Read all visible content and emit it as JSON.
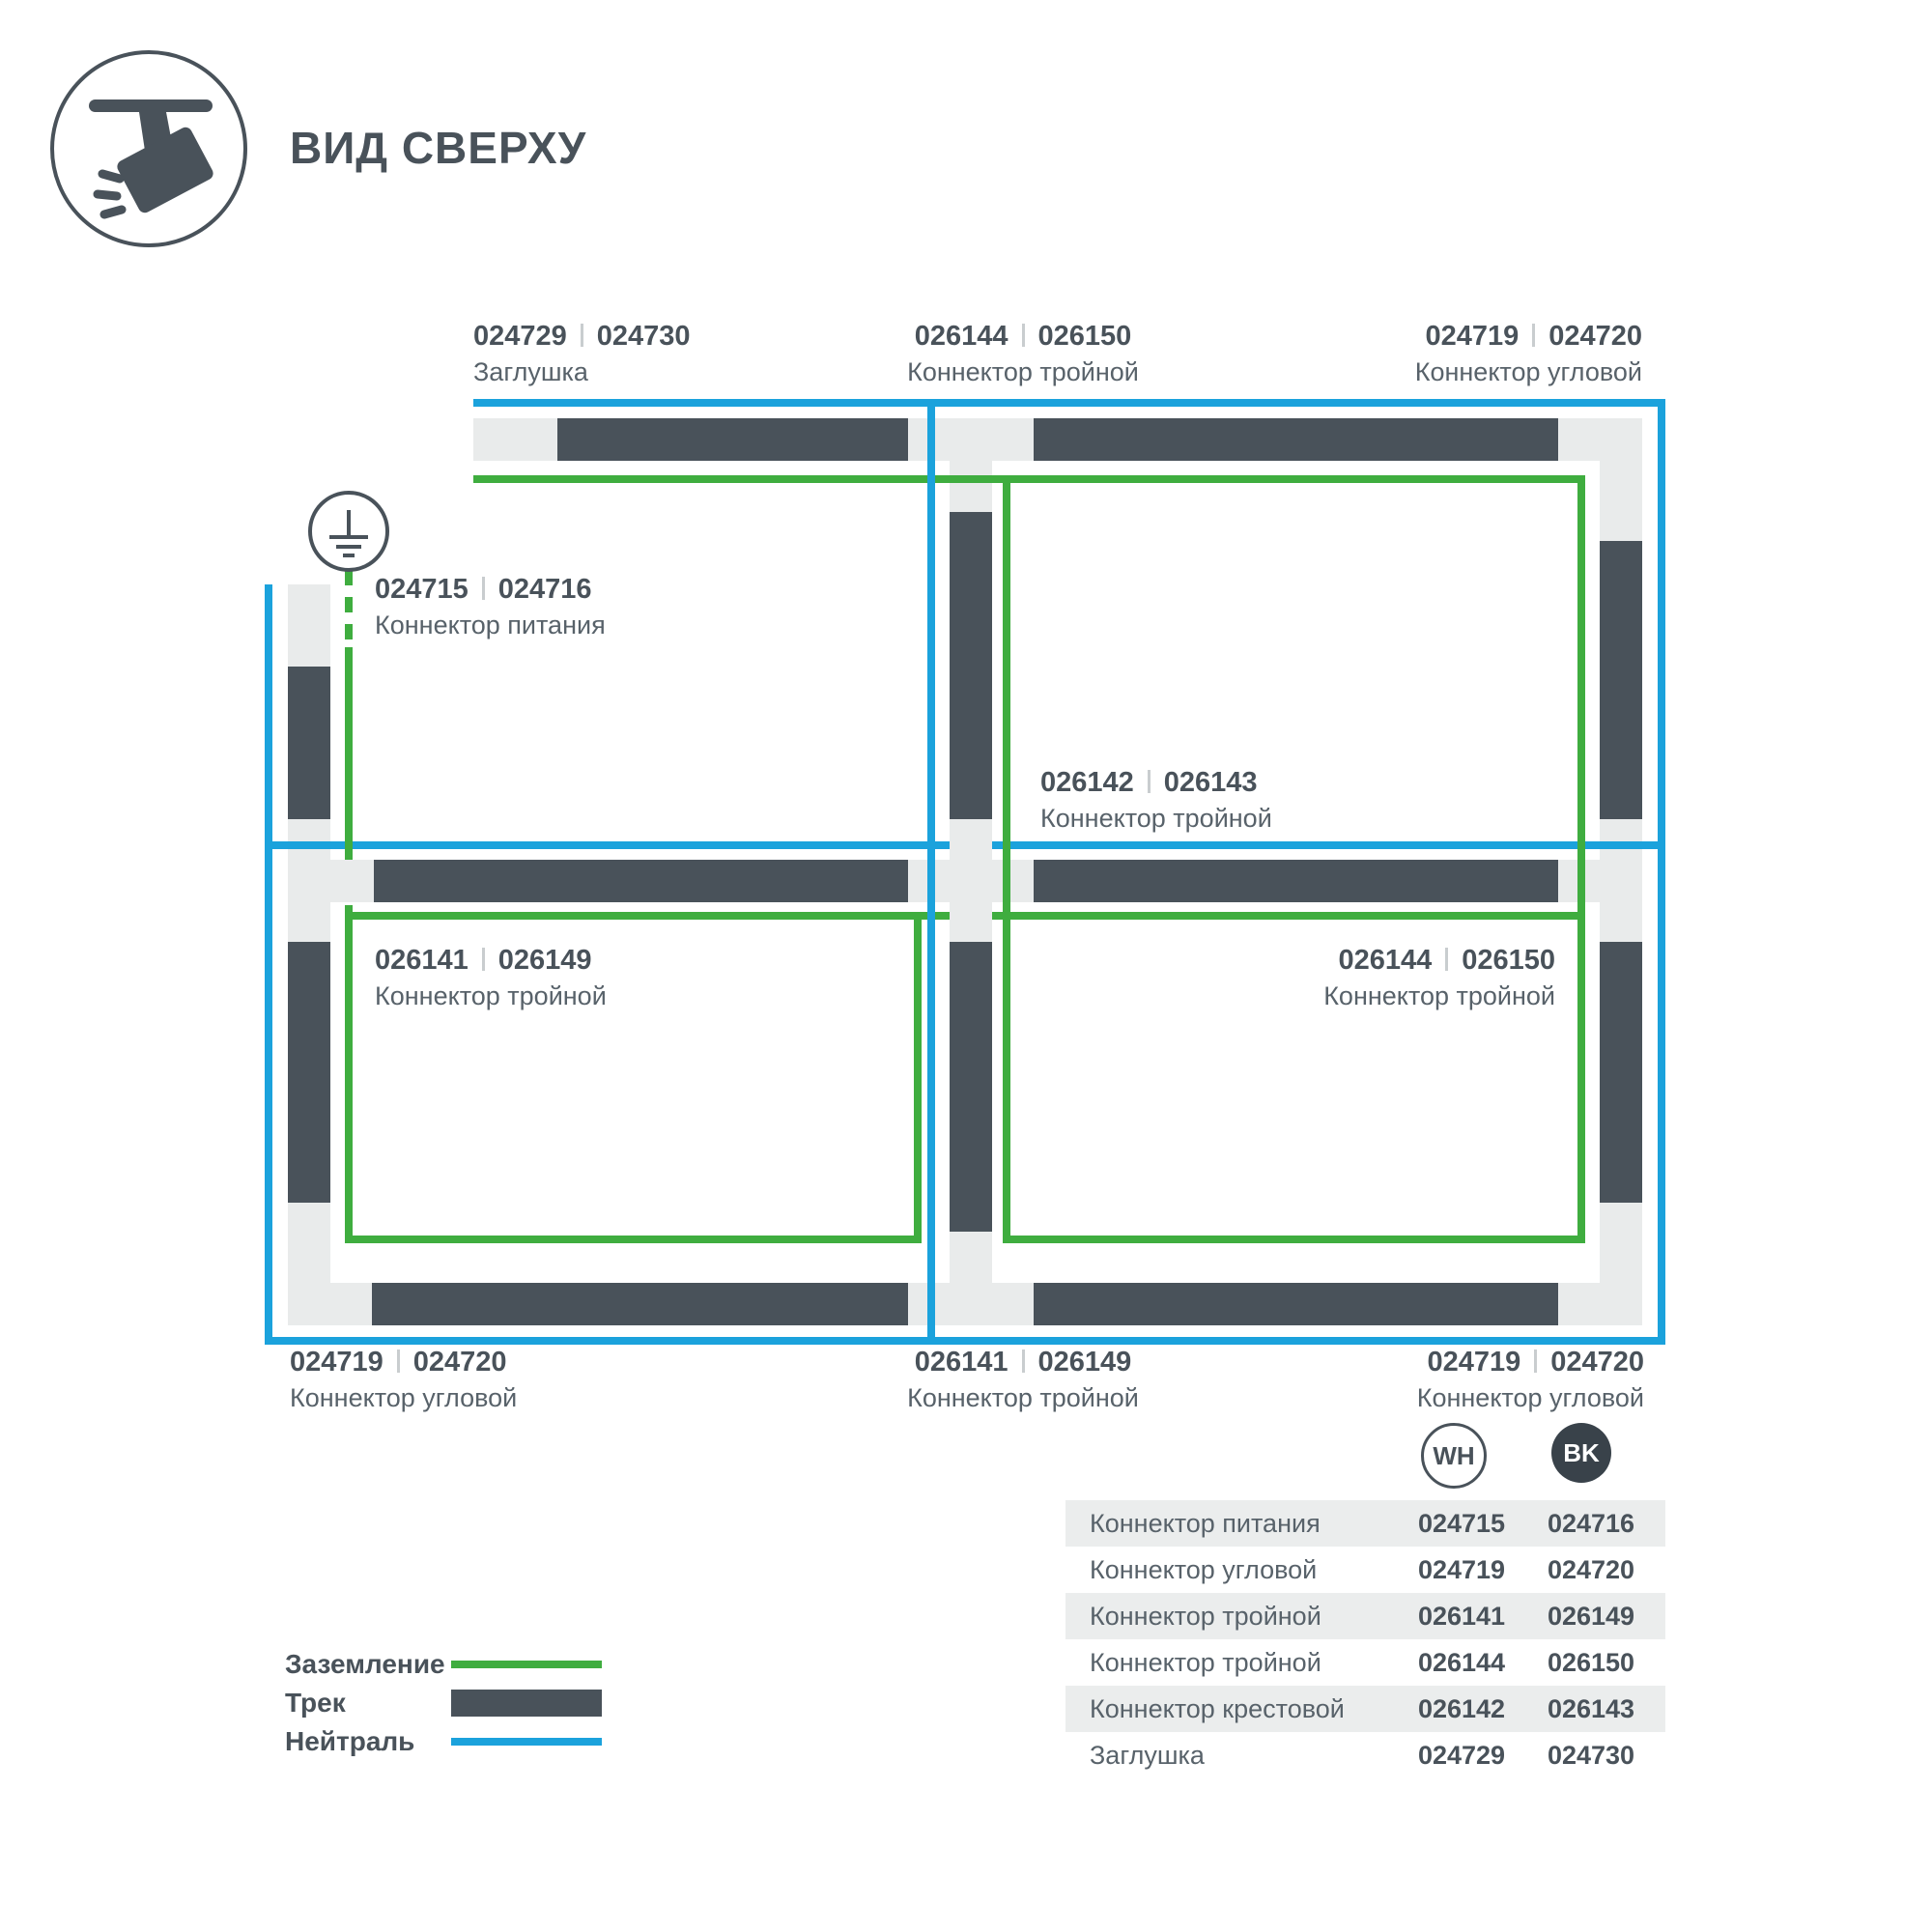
{
  "header": {
    "title": "ВИД СВЕРХУ"
  },
  "colors": {
    "track": "#49525A",
    "connector": "#E9EBEB",
    "neutral_blue": "#1BA2DC",
    "ground_green": "#3FAD3F",
    "table_row_gray": "#EBEDED"
  },
  "diagram": {
    "labels": {
      "l1": {
        "wh": "024729",
        "bk": "024730",
        "name": "Заглушка"
      },
      "l2": {
        "wh": "026144",
        "bk": "026150",
        "name": "Коннектор тройной"
      },
      "l3": {
        "wh": "024719",
        "bk": "024720",
        "name": "Коннектор угловой"
      },
      "l4": {
        "wh": "024715",
        "bk": "024716",
        "name": "Коннектор питания"
      },
      "l5": {
        "wh": "026142",
        "bk": "026143",
        "name": "Коннектор тройной"
      },
      "l6": {
        "wh": "026141",
        "bk": "026149",
        "name": "Коннектор тройной"
      },
      "l7": {
        "wh": "026144",
        "bk": "026150",
        "name": "Коннектор тройной"
      },
      "l8": {
        "wh": "024719",
        "bk": "024720",
        "name": "Коннектор угловой"
      },
      "l9": {
        "wh": "026141",
        "bk": "026149",
        "name": "Коннектор тройной"
      },
      "l10": {
        "wh": "024719",
        "bk": "024720",
        "name": "Коннектор угловой"
      }
    }
  },
  "legend": {
    "ground": "Заземление",
    "track": "Трек",
    "neutral": "Нейтраль"
  },
  "badges": {
    "wh": "WH",
    "bk": "BK"
  },
  "table": {
    "rows": [
      {
        "name": "Коннектор питания",
        "wh": "024715",
        "bk": "024716"
      },
      {
        "name": "Коннектор угловой",
        "wh": "024719",
        "bk": "024720"
      },
      {
        "name": "Коннектор тройной",
        "wh": "026141",
        "bk": "026149"
      },
      {
        "name": "Коннектор тройной",
        "wh": "026144",
        "bk": "026150"
      },
      {
        "name": "Коннектор крестовой",
        "wh": "026142",
        "bk": "026143"
      },
      {
        "name": "Заглушка",
        "wh": "024729",
        "bk": "024730"
      }
    ]
  }
}
